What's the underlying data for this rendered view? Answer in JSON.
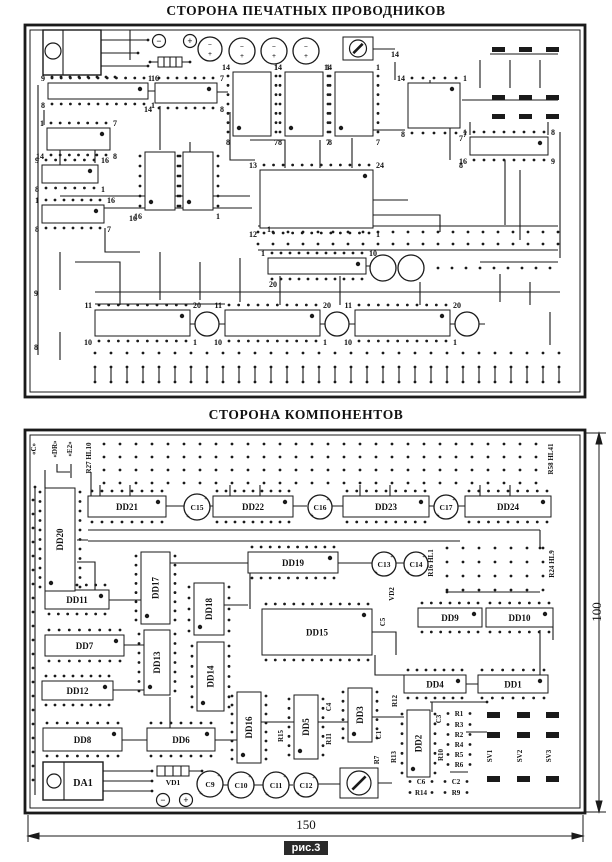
{
  "titles": {
    "top": "СТОРОНА ПЕЧАТНЫХ ПРОВОДНИКОВ",
    "bottom": "СТОРОНА КОМПОНЕНТОВ"
  },
  "caption": "рис.3",
  "dimensions": {
    "width_mm": "150",
    "height_mm": "100"
  },
  "colors": {
    "ink": "#1a1a1a",
    "paper": "#ffffff"
  },
  "top_board": {
    "frame": {
      "x": 25,
      "y": 25,
      "w": 560,
      "h": 372
    },
    "transistor": {
      "x": 43,
      "y": 30,
      "w": 58,
      "h": 45
    },
    "diode": {
      "x": 158,
      "y": 57,
      "w": 24,
      "h": 10
    },
    "trimmer": {
      "x": 343,
      "y": 37,
      "w": 30,
      "h": 23
    },
    "terminals": [
      {
        "x": 159,
        "y": 41,
        "sign": "−"
      },
      {
        "x": 190,
        "y": 41,
        "sign": "+"
      }
    ],
    "capacitors": [
      {
        "x": 210,
        "y": 49,
        "r": 12,
        "pol": true
      },
      {
        "x": 242,
        "y": 51,
        "r": 13,
        "pol": true
      },
      {
        "x": 274,
        "y": 51,
        "r": 13,
        "pol": true
      },
      {
        "x": 306,
        "y": 51,
        "r": 13,
        "pol": true
      },
      {
        "x": 383,
        "y": 268,
        "r": 13,
        "pol": false
      },
      {
        "x": 411,
        "y": 268,
        "r": 13,
        "pol": false
      },
      {
        "x": 207,
        "y": 324,
        "r": 12,
        "pol": false
      },
      {
        "x": 337,
        "y": 324,
        "r": 12,
        "pol": false
      },
      {
        "x": 467,
        "y": 324,
        "r": 12,
        "pol": false
      }
    ],
    "footprints": [
      {
        "x": 48,
        "y": 83,
        "w": 100,
        "h": 16,
        "tl": "9",
        "tr": "16",
        "bl": "8",
        "br": "1"
      },
      {
        "x": 155,
        "y": 83,
        "w": 62,
        "h": 20,
        "tl": "1",
        "tr": "7",
        "bl": "14",
        "br": "8"
      },
      {
        "x": 47,
        "y": 128,
        "w": 63,
        "h": 22,
        "tl": "1",
        "tr": "7",
        "bl": "14",
        "br": "8"
      },
      {
        "x": 42,
        "y": 165,
        "w": 56,
        "h": 18,
        "tl": "9",
        "tr": "16",
        "bl": "8",
        "br": "1"
      },
      {
        "x": 42,
        "y": 205,
        "w": 62,
        "h": 18,
        "tl": "1",
        "tr": "16",
        "bl": "8",
        "br": "7"
      },
      {
        "x": 145,
        "y": 152,
        "w": 30,
        "h": 58,
        "tl": "",
        "tr": "",
        "bl": "16",
        "br": ""
      },
      {
        "x": 183,
        "y": 152,
        "w": 30,
        "h": 58,
        "tl": "",
        "tr": "",
        "bl": "",
        "br": "1"
      },
      {
        "x": 233,
        "y": 72,
        "w": 38,
        "h": 64,
        "tl": "14",
        "tr": "1",
        "bl": "8",
        "br": "7"
      },
      {
        "x": 285,
        "y": 72,
        "w": 38,
        "h": 64,
        "tl": "14",
        "tr": "1",
        "bl": "8",
        "br": "7"
      },
      {
        "x": 335,
        "y": 72,
        "w": 38,
        "h": 64,
        "tl": "14",
        "tr": "1",
        "bl": "8",
        "br": "7"
      },
      {
        "x": 408,
        "y": 83,
        "w": 52,
        "h": 45,
        "tl": "14",
        "tr": "1",
        "bl": "8",
        "br": "7"
      },
      {
        "x": 470,
        "y": 137,
        "w": 78,
        "h": 18,
        "tl": "1",
        "tr": "8",
        "bl": "16",
        "br": "9"
      },
      {
        "x": 260,
        "y": 170,
        "w": 113,
        "h": 58,
        "tl": "13",
        "tr": "24",
        "bl": "12",
        "br": "1"
      },
      {
        "x": 268,
        "y": 258,
        "w": 98,
        "h": 16,
        "tl": "1",
        "tr": "10",
        "bl": "",
        "br": ""
      },
      {
        "x": 95,
        "y": 310,
        "w": 95,
        "h": 26,
        "tl": "11",
        "tr": "20",
        "bl": "10",
        "br": "1"
      },
      {
        "x": 225,
        "y": 310,
        "w": 95,
        "h": 26,
        "tl": "11",
        "tr": "20",
        "bl": "10",
        "br": "1"
      },
      {
        "x": 355,
        "y": 310,
        "w": 95,
        "h": 26,
        "tl": "11",
        "tr": "20",
        "bl": "10",
        "br": "1"
      }
    ],
    "pads": {
      "cols": [
        492,
        519,
        546
      ],
      "rows": [
        47,
        95,
        114
      ],
      "w": 13,
      "h": 5
    },
    "ladder": {
      "x0": 95,
      "x1": 571,
      "step": 16,
      "y0": 367,
      "y1": 382
    },
    "dot_rows": [
      {
        "x0": 258,
        "y": 232,
        "n": 21,
        "dx": 15
      },
      {
        "x0": 258,
        "y": 244,
        "n": 21,
        "dx": 15
      },
      {
        "x0": 438,
        "y": 268,
        "n": 9,
        "dx": 14
      },
      {
        "x0": 95,
        "y": 353,
        "n": 30,
        "dx": 16
      },
      {
        "x0": 52,
        "y": 77,
        "n": 8,
        "dx": 9
      }
    ],
    "float_labels": [
      {
        "t": "16",
        "x": 133,
        "y": 221
      },
      {
        "t": "1",
        "x": 269,
        "y": 232
      },
      {
        "t": "20",
        "x": 273,
        "y": 287
      },
      {
        "t": "14",
        "x": 395,
        "y": 57
      },
      {
        "t": "7",
        "x": 461,
        "y": 141
      },
      {
        "t": "8",
        "x": 461,
        "y": 168
      },
      {
        "t": "8",
        "x": 36,
        "y": 350
      },
      {
        "t": "9",
        "x": 36,
        "y": 296
      }
    ]
  },
  "bottom_board": {
    "frame": {
      "x": 25,
      "y": 430,
      "w": 560,
      "h": 383
    },
    "ics_h": [
      {
        "id": "DD21",
        "x": 88,
        "y": 496,
        "w": 78,
        "h": 21
      },
      {
        "id": "DD22",
        "x": 213,
        "y": 496,
        "w": 80,
        "h": 21
      },
      {
        "id": "DD23",
        "x": 343,
        "y": 496,
        "w": 86,
        "h": 21
      },
      {
        "id": "DD24",
        "x": 465,
        "y": 496,
        "w": 86,
        "h": 21
      },
      {
        "id": "DD19",
        "x": 248,
        "y": 552,
        "w": 90,
        "h": 21
      },
      {
        "id": "DD11",
        "x": 45,
        "y": 590,
        "w": 64,
        "h": 19
      },
      {
        "id": "DD7",
        "x": 45,
        "y": 635,
        "w": 79,
        "h": 21
      },
      {
        "id": "DD12",
        "x": 42,
        "y": 681,
        "w": 71,
        "h": 19
      },
      {
        "id": "DD9",
        "x": 418,
        "y": 608,
        "w": 64,
        "h": 19
      },
      {
        "id": "DD10",
        "x": 486,
        "y": 608,
        "w": 67,
        "h": 19
      },
      {
        "id": "DD15",
        "x": 262,
        "y": 609,
        "w": 110,
        "h": 46
      },
      {
        "id": "DD4",
        "x": 404,
        "y": 675,
        "w": 62,
        "h": 18
      },
      {
        "id": "DD1",
        "x": 478,
        "y": 675,
        "w": 70,
        "h": 18
      },
      {
        "id": "DD8",
        "x": 43,
        "y": 728,
        "w": 79,
        "h": 23
      },
      {
        "id": "DD6",
        "x": 147,
        "y": 728,
        "w": 68,
        "h": 23
      }
    ],
    "ics_v": [
      {
        "id": "DD20",
        "x": 45,
        "y": 488,
        "w": 30,
        "h": 103
      },
      {
        "id": "DD17",
        "x": 141,
        "y": 552,
        "w": 29,
        "h": 72
      },
      {
        "id": "DD18",
        "x": 194,
        "y": 583,
        "w": 30,
        "h": 52
      },
      {
        "id": "DD13",
        "x": 144,
        "y": 630,
        "w": 26,
        "h": 65
      },
      {
        "id": "DD14",
        "x": 197,
        "y": 642,
        "w": 27,
        "h": 69
      },
      {
        "id": "DD16",
        "x": 237,
        "y": 692,
        "w": 24,
        "h": 71
      },
      {
        "id": "DD5",
        "x": 294,
        "y": 695,
        "w": 24,
        "h": 64
      },
      {
        "id": "DD3",
        "x": 348,
        "y": 688,
        "w": 24,
        "h": 54
      },
      {
        "id": "DD2",
        "x": 407,
        "y": 710,
        "w": 23,
        "h": 67
      }
    ],
    "capacitors": [
      {
        "id": "C15",
        "x": 197,
        "y": 507,
        "r": 13
      },
      {
        "id": "C16",
        "x": 320,
        "y": 507,
        "r": 12
      },
      {
        "id": "C17",
        "x": 446,
        "y": 507,
        "r": 12
      },
      {
        "id": "C13",
        "x": 384,
        "y": 564,
        "r": 12
      },
      {
        "id": "C14",
        "x": 416,
        "y": 564,
        "r": 12
      },
      {
        "id": "C9",
        "x": 210,
        "y": 784,
        "r": 13
      },
      {
        "id": "C10",
        "x": 241,
        "y": 785,
        "r": 13
      },
      {
        "id": "C11",
        "x": 276,
        "y": 785,
        "r": 13
      },
      {
        "id": "C12",
        "x": 306,
        "y": 785,
        "r": 12
      }
    ],
    "rotated_labels": [
      {
        "t": "«C»",
        "x": 36,
        "y": 449
      },
      {
        "t": "«DR»",
        "x": 57,
        "y": 449
      },
      {
        "t": "«E2»",
        "x": 72,
        "y": 449
      },
      {
        "t": "R27 HL10",
        "x": 91,
        "y": 458
      },
      {
        "t": "R58 HL41",
        "x": 553,
        "y": 459
      },
      {
        "t": "R16 HL1",
        "x": 433,
        "y": 563
      },
      {
        "t": "R24 HL9",
        "x": 554,
        "y": 564
      },
      {
        "t": "VD2",
        "x": 394,
        "y": 594
      },
      {
        "t": "C5",
        "x": 385,
        "y": 622
      },
      {
        "t": "R12",
        "x": 397,
        "y": 701
      },
      {
        "t": "C4",
        "x": 331,
        "y": 707
      },
      {
        "t": "R15",
        "x": 283,
        "y": 736
      },
      {
        "t": "R11",
        "x": 331,
        "y": 739
      },
      {
        "t": "C1",
        "x": 381,
        "y": 735
      },
      {
        "t": "R7",
        "x": 379,
        "y": 760
      },
      {
        "t": "R13",
        "x": 396,
        "y": 757
      },
      {
        "t": "C3",
        "x": 441,
        "y": 719
      },
      {
        "t": "R10",
        "x": 443,
        "y": 755
      },
      {
        "t": "R8",
        "x": 346,
        "y": 784
      },
      {
        "t": "SV1",
        "x": 492,
        "y": 756
      },
      {
        "t": "SV2",
        "x": 522,
        "y": 756
      },
      {
        "t": "SV3",
        "x": 551,
        "y": 756
      }
    ],
    "small_labels": [
      {
        "t": "R1",
        "x": 459,
        "y": 716
      },
      {
        "t": "R3",
        "x": 459,
        "y": 727
      },
      {
        "t": "R2",
        "x": 459,
        "y": 737
      },
      {
        "t": "R4",
        "x": 459,
        "y": 747
      },
      {
        "t": "R5",
        "x": 459,
        "y": 757
      },
      {
        "t": "R6",
        "x": 459,
        "y": 767
      },
      {
        "t": "C6",
        "x": 421,
        "y": 784
      },
      {
        "t": "R14",
        "x": 421,
        "y": 795
      },
      {
        "t": "C2",
        "x": 456,
        "y": 784
      },
      {
        "t": "R9",
        "x": 456,
        "y": 795
      }
    ],
    "sv_pads": {
      "cols": [
        487,
        517,
        546
      ],
      "rows": [
        712,
        732,
        776
      ],
      "w": 13,
      "h": 6
    },
    "da1": {
      "id": "DA1",
      "x": 43,
      "y": 762,
      "w": 60,
      "h": 38
    },
    "vd1": {
      "id": "VD1",
      "x": 157,
      "y": 766,
      "w": 32,
      "h": 10
    },
    "r8_trimmer": {
      "x": 340,
      "y": 768,
      "w": 38,
      "h": 30
    },
    "terminals": [
      {
        "x": 163,
        "y": 800,
        "sign": "−"
      },
      {
        "x": 186,
        "y": 800,
        "sign": "+"
      }
    ],
    "dot_grids": [
      {
        "x0": 104,
        "y0": 444,
        "dx": 16,
        "dy": 13,
        "cols": 28,
        "rows": 4
      },
      {
        "x0": 447,
        "y0": 548,
        "dx": 16,
        "dy": 14,
        "cols": 7,
        "rows": 4
      },
      {
        "x0": 33,
        "y0": 500,
        "dx": 0,
        "dy": 14,
        "cols": 1,
        "rows": 21
      }
    ]
  },
  "extra_dots": [
    [
      148,
      40
    ],
    [
      138,
      53
    ],
    [
      148,
      66
    ],
    [
      150,
      62
    ],
    [
      190,
      62
    ],
    [
      152,
      771
    ],
    [
      152,
      781
    ],
    [
      152,
      791
    ],
    [
      202,
      771
    ],
    [
      35,
      487
    ],
    [
      540,
      548
    ],
    [
      447,
      592
    ],
    [
      487,
      702
    ]
  ]
}
